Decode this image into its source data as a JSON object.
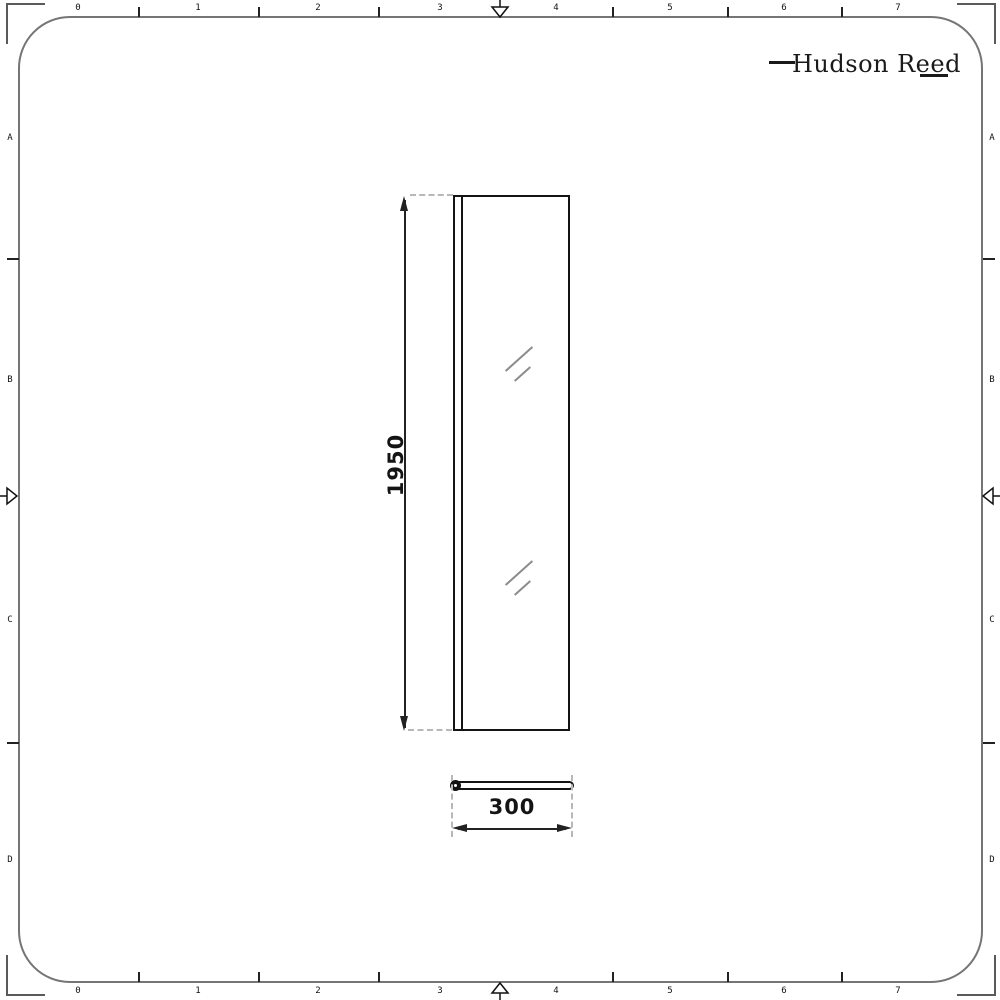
{
  "brand": {
    "logo_text": "Hudson Reed"
  },
  "ruler": {
    "column_labels": [
      "0",
      "1",
      "2",
      "3",
      "4",
      "5",
      "6",
      "7"
    ],
    "row_labels": [
      "A",
      "B",
      "C",
      "D"
    ]
  },
  "drawing": {
    "front_view": {
      "height_dim": "1950"
    },
    "plan_view": {
      "width_dim": "300"
    }
  },
  "palette": {
    "line": "#141414",
    "frame_border": "#757575",
    "extension_dash": "#b8b8b8",
    "glass_hatch": "#8c8c8c",
    "background": "#ffffff"
  }
}
